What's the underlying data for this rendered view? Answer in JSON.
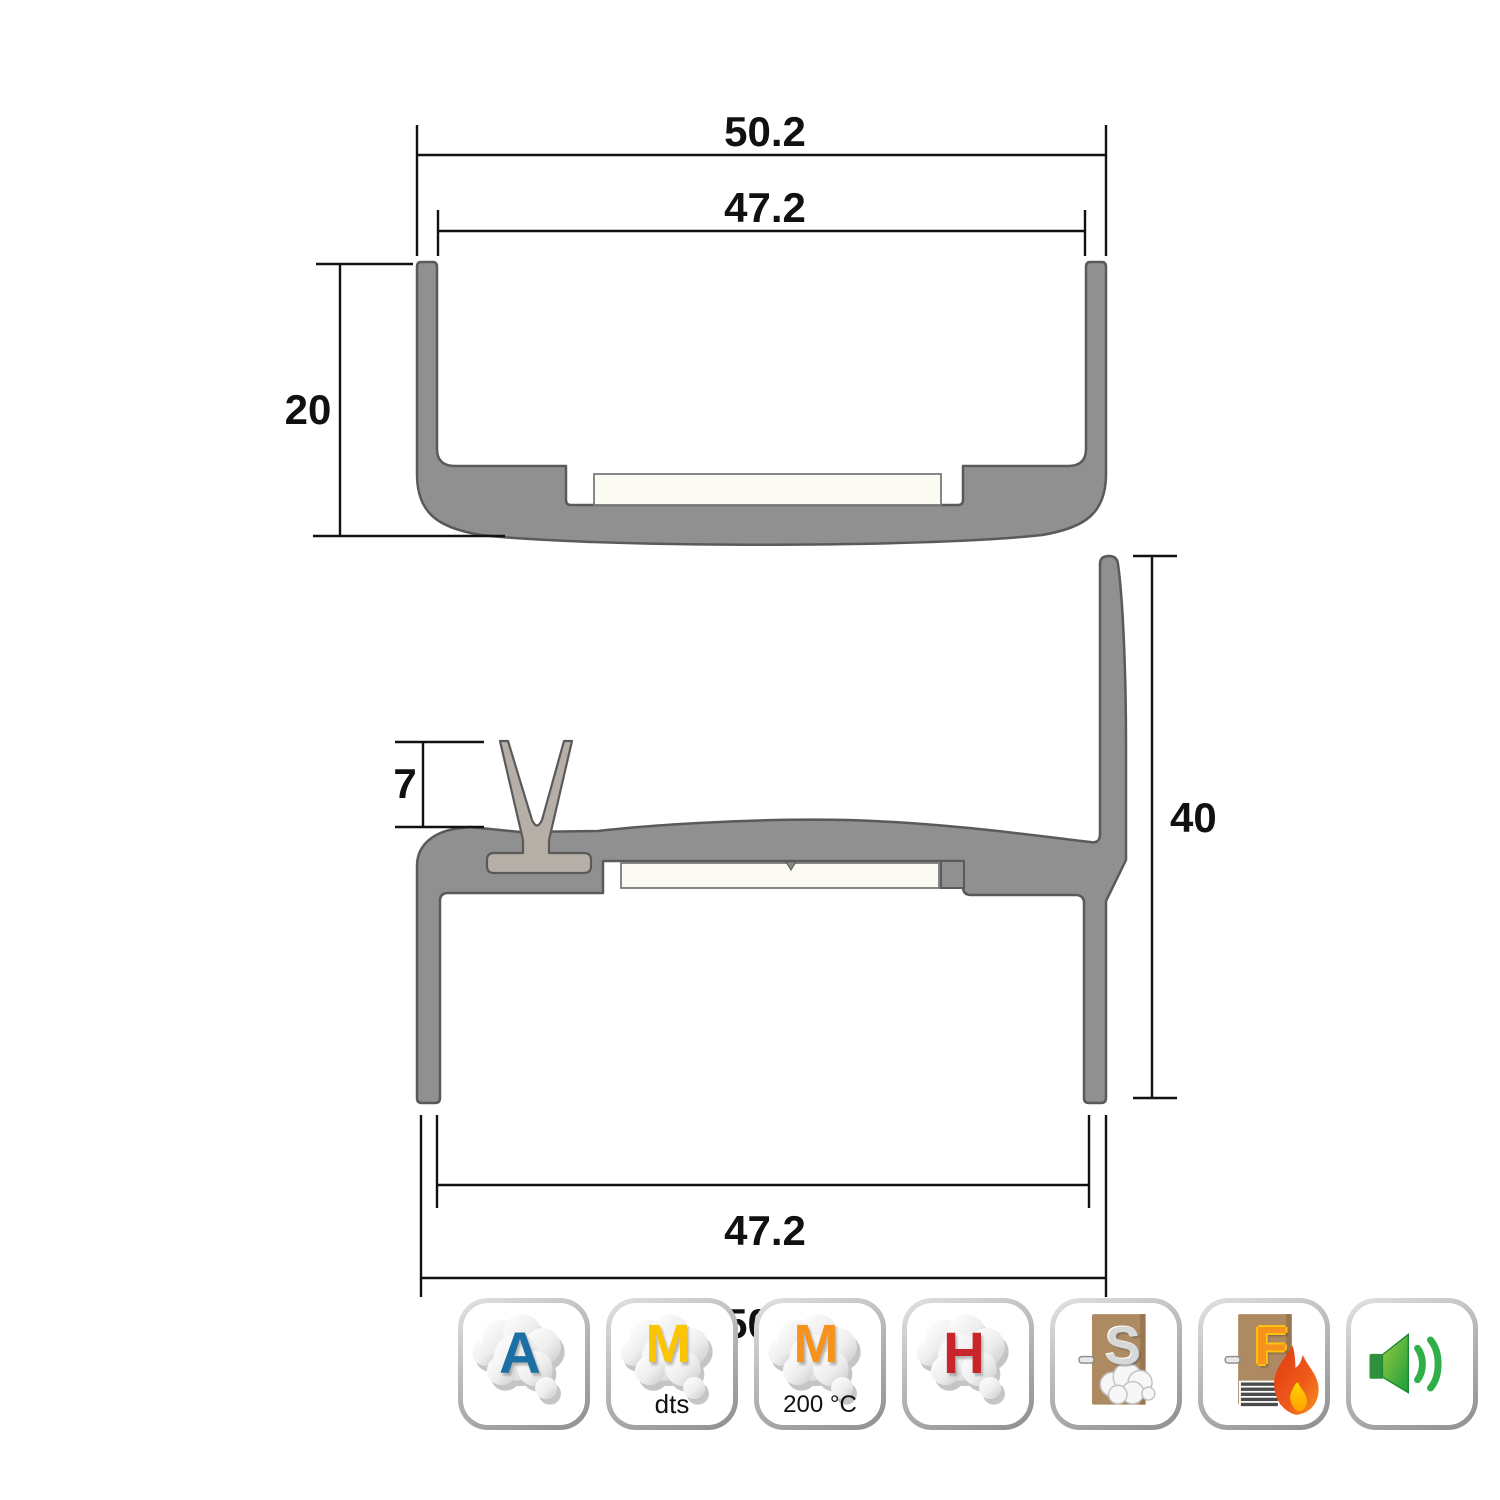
{
  "drawing": {
    "top_profile": {
      "label": "u-channel-frame-section",
      "dim_outer_width": "50.2",
      "dim_inner_width": "47.2",
      "dim_height": "20"
    },
    "bottom_profile": {
      "label": "threshold-sill-section",
      "dim_seal_height": "7",
      "dim_upstand_height": "40",
      "dim_inner_width": "47.2",
      "dim_outer_width": "50.2"
    },
    "colors": {
      "profile_fill": "#909090",
      "profile_outline": "#5a5a5a",
      "seal_fill": "#b6afa8",
      "insert_fill": "#fbfaf3",
      "dimension_line": "#111111"
    }
  },
  "icons": {
    "acoustic_a": {
      "letter": "A",
      "letter_color": "#1c6fa4"
    },
    "mechanical_dts": {
      "letter": "M",
      "letter_color": "#fdc500",
      "caption": "dts"
    },
    "mechanical_temp": {
      "letter": "M",
      "letter_color": "#f6921e",
      "caption": "200 °C"
    },
    "hygiene_h": {
      "letter": "H",
      "letter_color": "#c8242b"
    },
    "smoke_door": {
      "letter": "S"
    },
    "fire_door": {
      "letter": "F"
    },
    "speaker": {
      "label": "acoustic-rated"
    }
  }
}
